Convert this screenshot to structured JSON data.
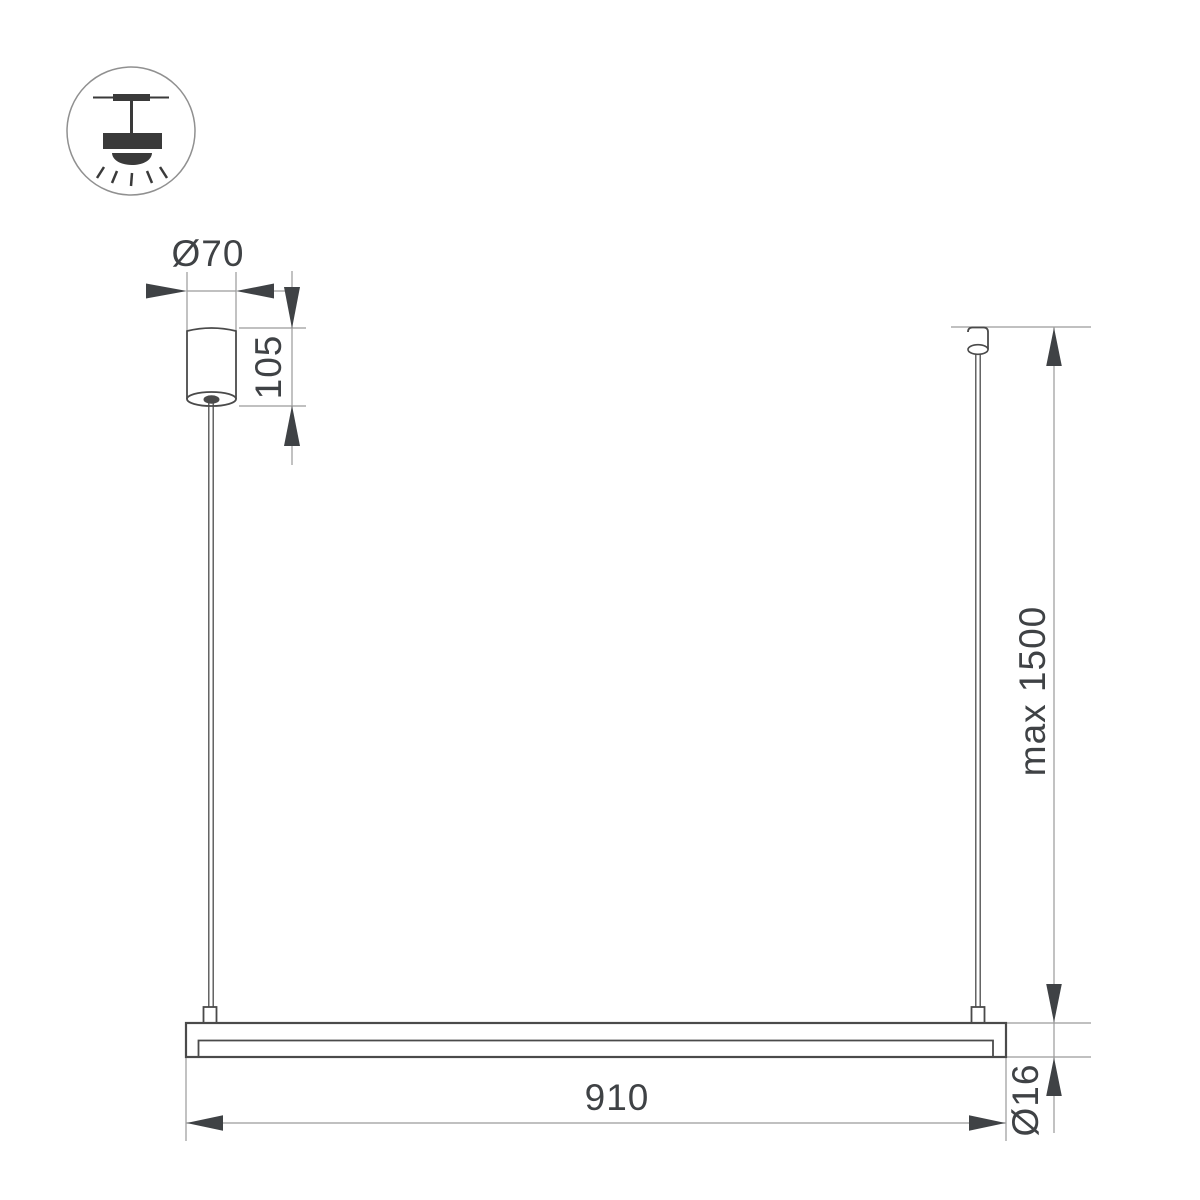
{
  "drawing": {
    "kind": "dimension-drawing-linear-pendant-luminaire",
    "labels": {
      "canopy_diameter": "Ø70",
      "canopy_height": "105",
      "suspension_max_length": "max 1500",
      "bar_length": "910",
      "bar_diameter": "Ø16"
    },
    "icon": {
      "name": "ceiling-pendant-mount-icon"
    },
    "colors": {
      "background": "#ffffff",
      "object_line": "#4a4a4a",
      "dimension_line": "#9a9a9a",
      "arrow_fill": "#3f4245",
      "text": "#3f4245",
      "icon_glyph": "#3a3a3a",
      "icon_circle_stroke": "#909090"
    }
  }
}
